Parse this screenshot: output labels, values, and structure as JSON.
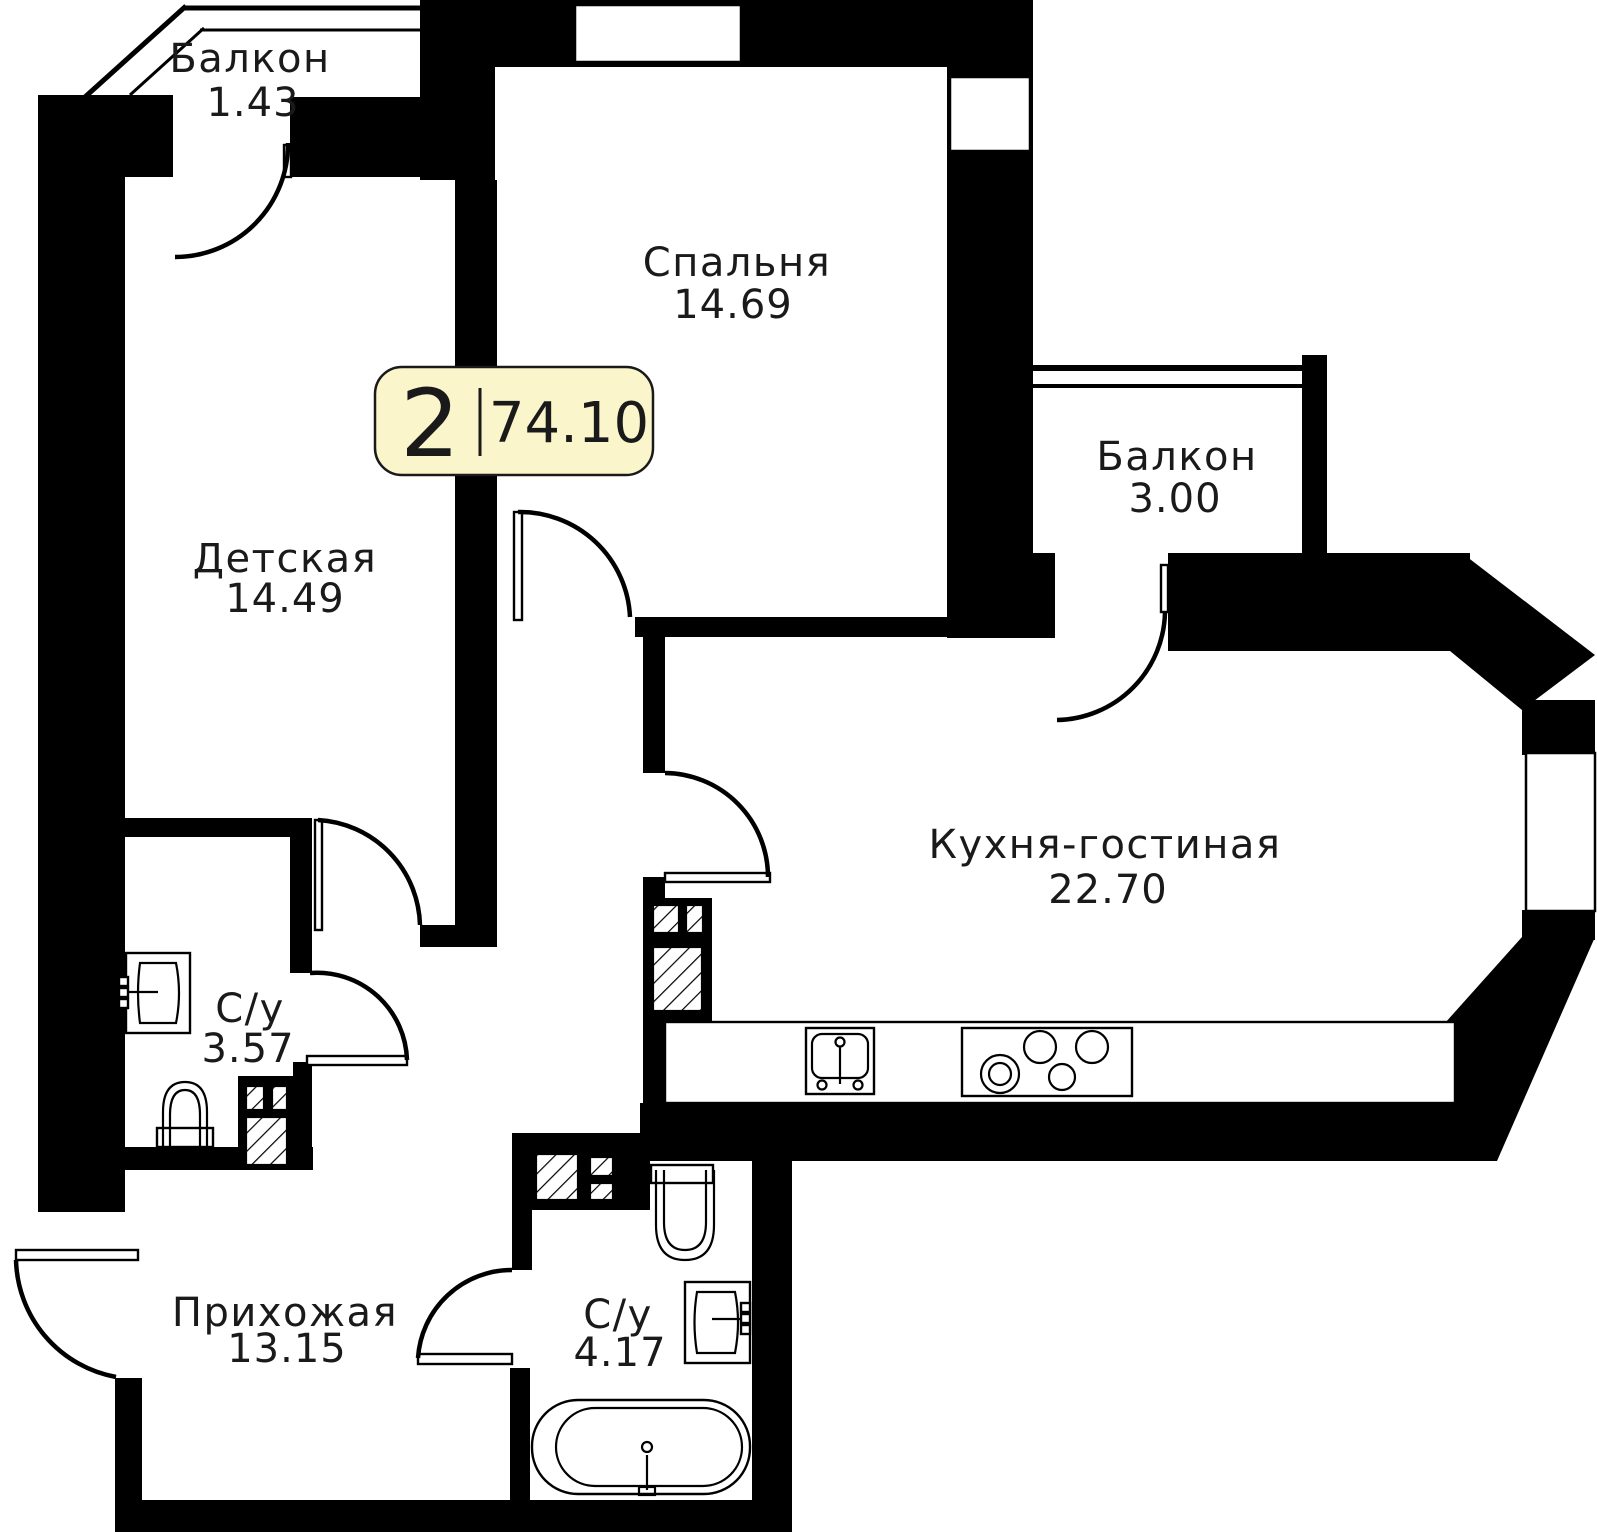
{
  "floor_plan": {
    "badge": {
      "rooms_count": "2",
      "total_area": "74.10"
    },
    "rooms": [
      {
        "key": "balcony_top_left",
        "label": "Балкон",
        "area": "1.43"
      },
      {
        "key": "bedroom",
        "label": "Спальня",
        "area": "14.69"
      },
      {
        "key": "children_room",
        "label": "Детская",
        "area": "14.49"
      },
      {
        "key": "balcony_right",
        "label": "Балкон",
        "area": "3.00"
      },
      {
        "key": "kitchen_living",
        "label": "Кухня-гостиная",
        "area": "22.70"
      },
      {
        "key": "bathroom_small",
        "label": "С/у",
        "area": "3.57"
      },
      {
        "key": "hallway",
        "label": "Прихожая",
        "area": "13.15"
      },
      {
        "key": "bathroom_large",
        "label": "С/у",
        "area": "4.17"
      }
    ],
    "colors": {
      "walls": "#000000",
      "background": "#FFFFFF",
      "badge_fill": "#FBF5CB",
      "badge_border": "#1A1A1A",
      "text": "#1A1A1A"
    }
  }
}
